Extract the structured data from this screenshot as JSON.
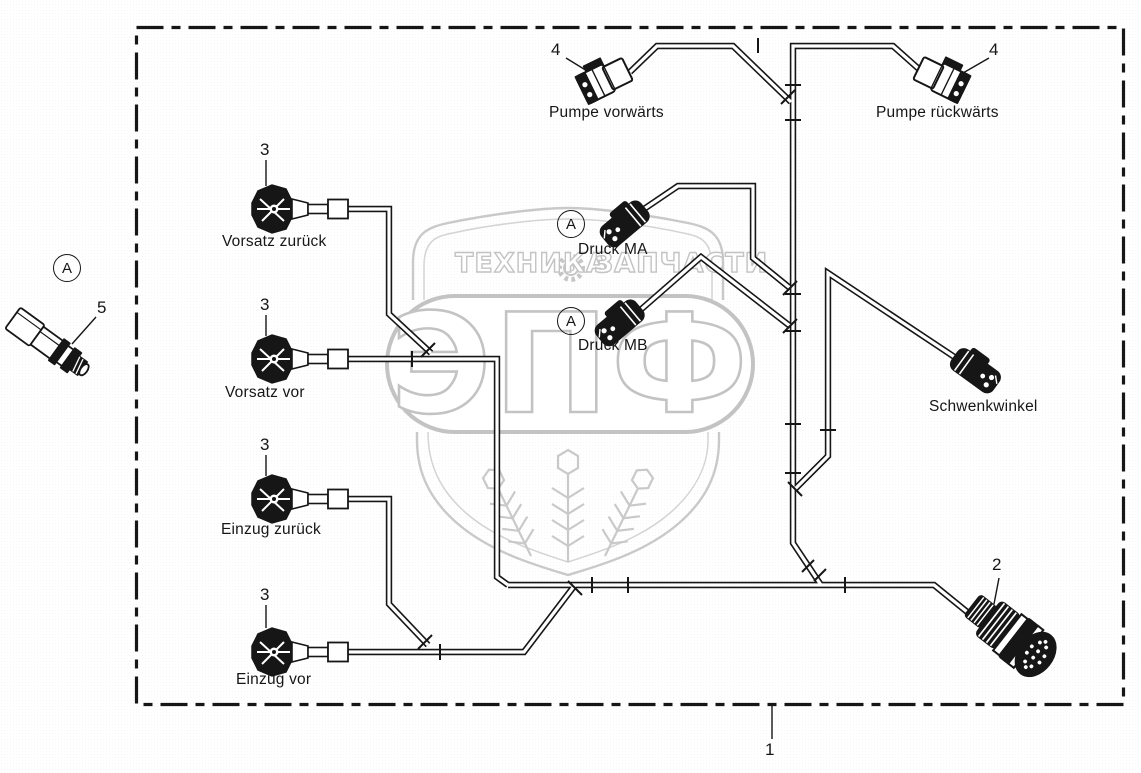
{
  "diagram_type": "wiring-harness-parts-diagram",
  "labels": {
    "pumpe_vorwaerts": "Pumpe vorwärts",
    "pumpe_rueckwaerts": "Pumpe rückwärts",
    "vorsatz_zurueck": "Vorsatz zurück",
    "vorsatz_vor": "Vorsatz vor",
    "einzug_zurueck": "Einzug zurück",
    "einzug_vor": "Einzug vor",
    "druck_ma": "Druck MA",
    "druck_mb": "Druck MB",
    "schwenkwinkel": "Schwenkwinkel"
  },
  "part_numbers": {
    "harness": "1",
    "main_connector": "2",
    "sensor_plug": "3",
    "pump_plug": "4",
    "pressure_sensor": "5"
  },
  "view_marker": "A",
  "watermark": {
    "word_left": "ТЕХНИКА",
    "word_right": "ЗАПЧАСТИ",
    "letters": "ЭПФ"
  },
  "colors": {
    "line": "#161616",
    "watermark_stroke": "#c3c3c3",
    "background": "#ffffff"
  }
}
